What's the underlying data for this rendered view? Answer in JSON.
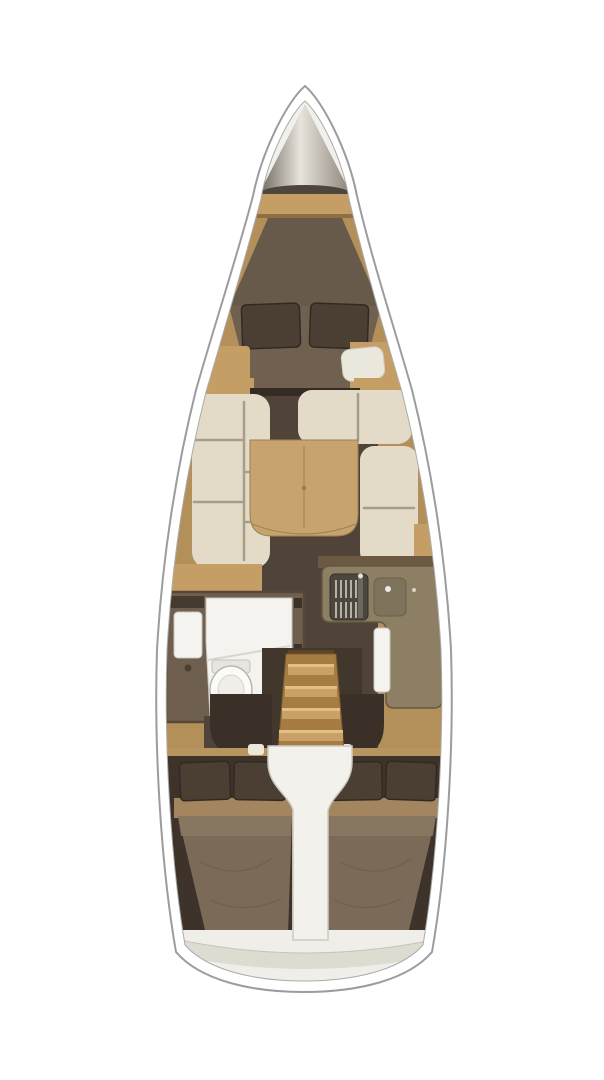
{
  "meta": {
    "title": "Sailboat interior layout — top-down floor plan, bow up",
    "note": "Architectural rendering with no visible text labels"
  },
  "colors": {
    "background": "#ffffff",
    "hull_line": "#9c9c9c",
    "hull_fill": "#ffffff",
    "inner_line": "#ababab",
    "bow_deck": "#f1f0ed",
    "anchor_metal_dark": "#6e665c",
    "anchor_metal_mid": "#8b8377",
    "anchor_metal_light": "#e8e4dc",
    "anchor_base": "#4e463c",
    "wood": "#b3905a",
    "wood_light": "#c59e66",
    "wood_dark": "#7c6138",
    "bed_head": "#685a4a",
    "bed_mattress": "#70604f",
    "pillow": "#4b3f34",
    "pillow_edge": "#322a22",
    "doorway": "#342c24",
    "floor": "#50443a",
    "cushion": "#e3dbc8",
    "cushion_seam": "#a69d87",
    "table": "#c7a46f",
    "table_edge": "#9f7f4c",
    "counter": "#8d7f63",
    "counter_edge": "#645843",
    "stove": "#4b473f",
    "stove_grate": "#d2ccbd",
    "fixture": "#f4f3ef",
    "fixture_line": "#c8c5bc",
    "head_floor": "#6e5f4e",
    "head_frame": "#564838",
    "entry_dark": "#3a3027",
    "stairs": "#a67c42",
    "stair_step": "#c9a167",
    "stair_step_hi": "#e2bf86",
    "engine_cover": "#f3f1ec",
    "engine_line": "#cdcac3",
    "aft_dark": "#3e332a",
    "aft_band": "#a3855f",
    "aft_mattress": "#7b6a58",
    "aft_mattress_hi": "#8b7962",
    "stern_light": "#f0eee8",
    "stern_band": "#dedbd0",
    "seat_white": "#eae8dc"
  },
  "regions": {
    "hull": {
      "label": "Hull outline, bow pointing up"
    },
    "anchor_locker": {
      "label": "Anchor locker at bow"
    },
    "forward_cabin": {
      "label": "Forward cabin — V-berth double bed with two pillows"
    },
    "forward_seat": {
      "label": "Forward cabin seat cushion"
    },
    "salon": {
      "label": "Main salon floor"
    },
    "port_settee": {
      "label": "Port settee with cream cushions"
    },
    "starboard_settee": {
      "label": "Starboard L-shaped settee with cream cushions"
    },
    "salon_table": {
      "label": "Salon dining table"
    },
    "head": {
      "label": "Head compartment — sink, toilet and shower"
    },
    "galley": {
      "label": "L-shaped galley with stove and sink"
    },
    "companionway": {
      "label": "Companionway stairs"
    },
    "engine_compartment": {
      "label": "Engine compartment cover under stairs"
    },
    "aft_cabin_port": {
      "label": "Port aft cabin — double berth with pillows"
    },
    "aft_cabin_starboard": {
      "label": "Starboard aft cabin — double berth with pillows"
    },
    "stern": {
      "label": "Rounded stern transom"
    }
  }
}
